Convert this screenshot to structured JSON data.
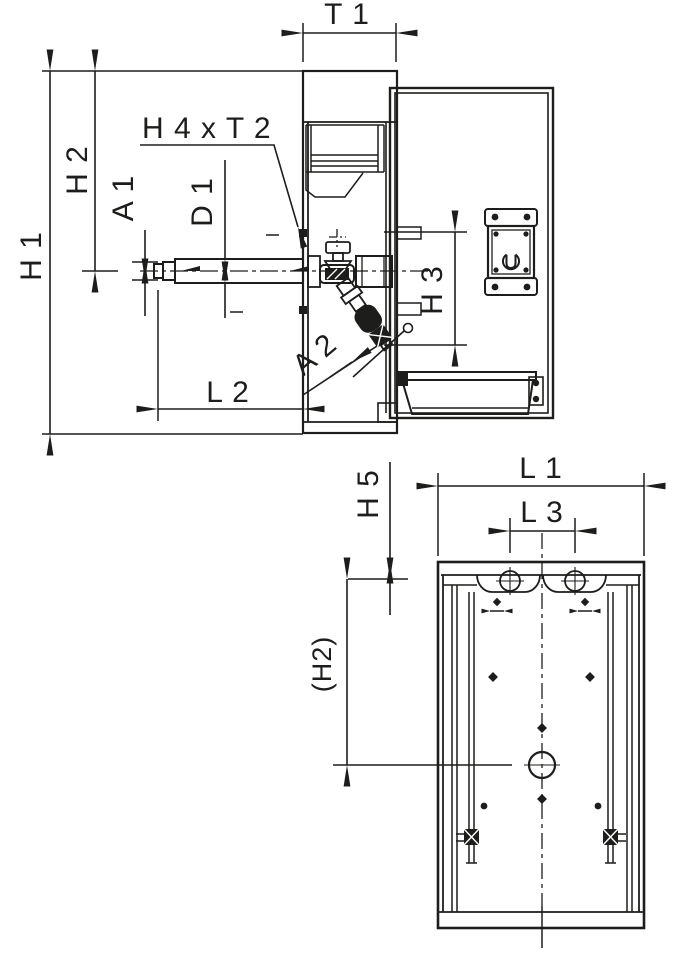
{
  "drawing": {
    "type": "technical_drawing",
    "background": "#ffffff",
    "line_color": "#1d1d1b",
    "side_view": {
      "name": "side-view",
      "dimensions": {
        "t1": "T 1",
        "h1": "H 1",
        "h2": "H 2",
        "a1": "A 1",
        "d1": "D 1",
        "h4xt2": "H 4 x T 2",
        "h3": "H 3",
        "a2": "A 2",
        "l2": "L 2"
      }
    },
    "front_view": {
      "name": "front-view",
      "dimensions": {
        "l1": "L 1",
        "l3": "L 3",
        "h5": "H 5",
        "h2_ref": "(H2)"
      }
    }
  }
}
